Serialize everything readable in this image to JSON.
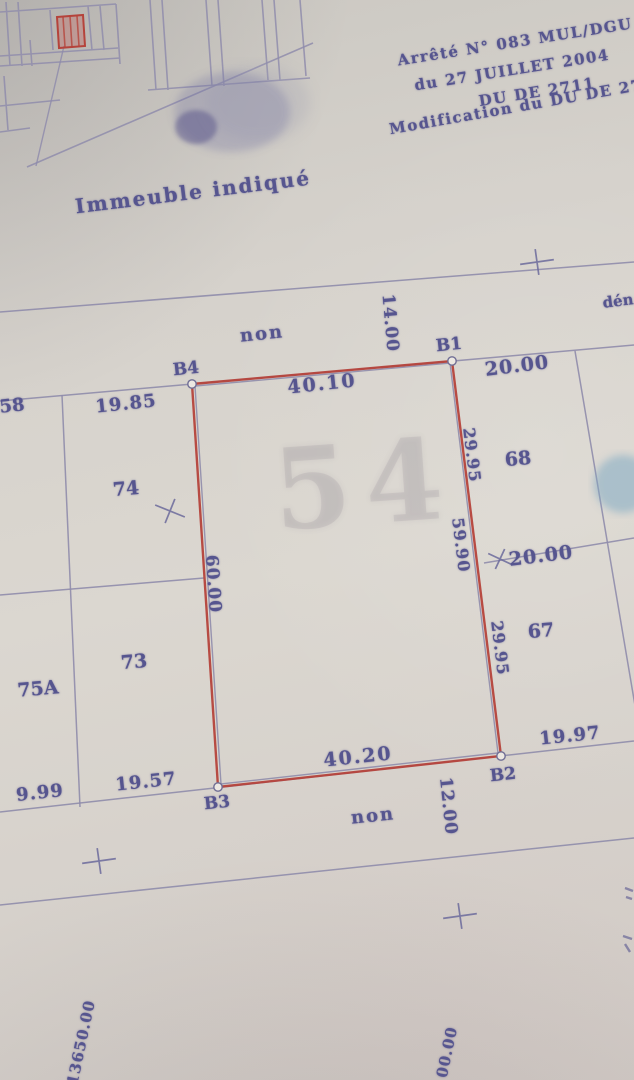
{
  "title_block": {
    "line1": "Arrêté N° 083 MUL/DGU",
    "line2": "du 27 JUILLET 2004",
    "line3": "DU DE 2711",
    "line4": "Modification du DU DE 27"
  },
  "inset_map": {
    "caption": "Immeuble indiqué"
  },
  "street_top": {
    "non": "non",
    "width": "14.00",
    "name_fragment": "dén"
  },
  "street_bottom": {
    "non": "non",
    "width": "12.00"
  },
  "parcel": {
    "b1": "B1",
    "b2": "B2",
    "b3": "B3",
    "b4": "B4",
    "top": "40.10",
    "bottom": "40.20",
    "left": "60.00",
    "right_upper": "29.95",
    "right_total": "59.90",
    "right_lower": "29.95",
    "watermark": "54"
  },
  "neighbors": {
    "p58": "58",
    "p74": "74",
    "p73": "73",
    "p75a": "75A",
    "p68": "68",
    "p67": "67"
  },
  "dims": {
    "d1985": "19.85",
    "d2000a": "20.00",
    "d2000b": "20.00",
    "d1997": "19.97",
    "d1957": "19.57",
    "d0999": "9.99"
  },
  "coords": {
    "left": "313650.00",
    "right": "00.00"
  },
  "colors": {
    "ink": "#56558f",
    "line": "#8f8cab",
    "red": "#b5433b",
    "stamp": "#7fa9c2",
    "paper": "#d6d2cc"
  }
}
